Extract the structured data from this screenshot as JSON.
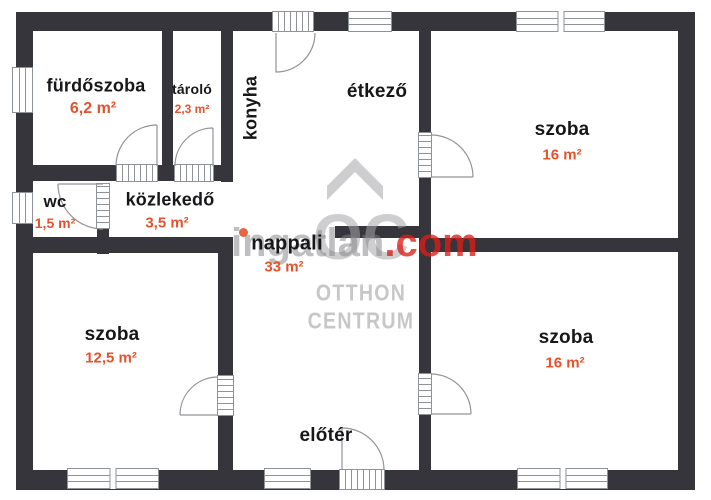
{
  "rooms": [
    {
      "id": "furdoszoba",
      "name": "fürdőszoba",
      "area": "6,2 m²"
    },
    {
      "id": "tarolo",
      "name": "tároló",
      "area": "2,3 m²"
    },
    {
      "id": "konyha",
      "name": "konyha",
      "area": ""
    },
    {
      "id": "etkezo",
      "name": "étkező",
      "area": ""
    },
    {
      "id": "szoba-top-right",
      "name": "szoba",
      "area": "16 m²"
    },
    {
      "id": "wc",
      "name": "wc",
      "area": "1,5 m²"
    },
    {
      "id": "kozlekedo",
      "name": "közlekedő",
      "area": "3,5 m²"
    },
    {
      "id": "nappali",
      "name": "nappali",
      "area": "33 m²"
    },
    {
      "id": "szoba-bottom-left",
      "name": "szoba",
      "area": "12,5 m²"
    },
    {
      "id": "eloter",
      "name": "előtér",
      "area": ""
    },
    {
      "id": "szoba-bottom-right",
      "name": "szoba",
      "area": "16 m²"
    }
  ],
  "watermark": {
    "brand_gray": "ingatlan",
    "brand_red": ".com",
    "logo_monogram": "OC",
    "logo_line1": "OTTHON",
    "logo_line2": "CENTRUM"
  },
  "colors": {
    "wall": "#36353b",
    "room_label": "#17171a",
    "area_label": "#e4532c",
    "watermark_red": "#db1e17",
    "watermark_gray": "#808085"
  }
}
